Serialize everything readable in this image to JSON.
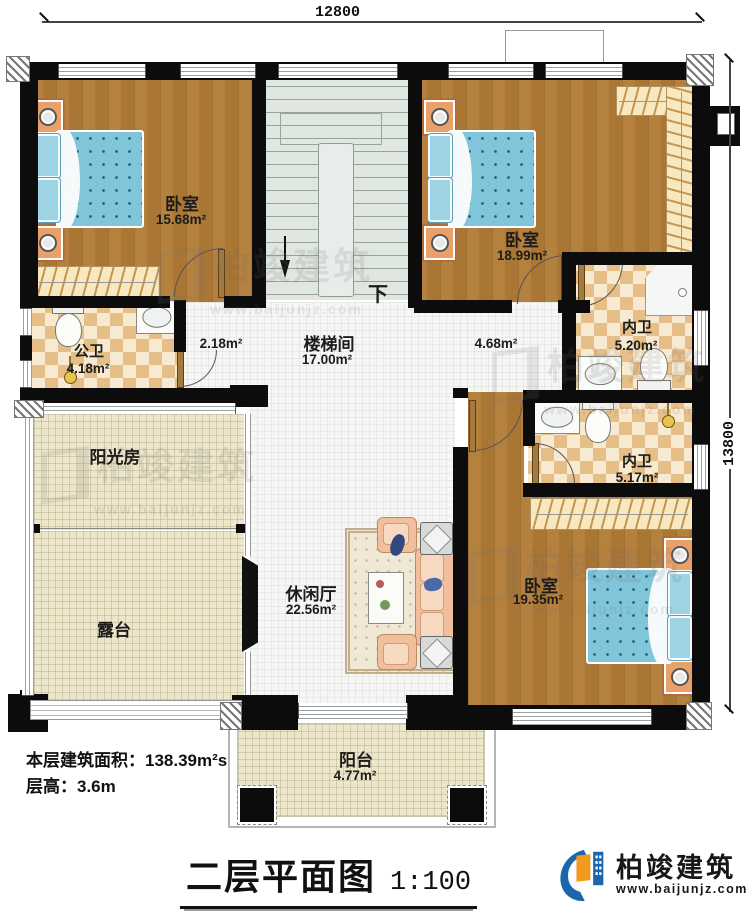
{
  "dimensions": {
    "top": "12800",
    "right": "13800"
  },
  "rooms": {
    "bedroom1": {
      "name": "卧室",
      "area": "15.68m²"
    },
    "bedroom2": {
      "name": "卧室",
      "area": "18.99m²"
    },
    "bedroom3": {
      "name": "卧室",
      "area": "19.35m²"
    },
    "stairwell": {
      "name": "楼梯间",
      "area": "17.00m²"
    },
    "public_bath": {
      "name": "公卫",
      "area": "4.18m²"
    },
    "corridor": {
      "area": "2.18m²"
    },
    "hall": {
      "area": "4.68m²"
    },
    "inner_bath1": {
      "name": "内卫",
      "area": "5.20m²"
    },
    "inner_bath2": {
      "name": "内卫",
      "area": "5.17m²"
    },
    "sunroom": {
      "name": "阳光房"
    },
    "terrace": {
      "name": "露台"
    },
    "leisure": {
      "name": "休闲厅",
      "area": "22.56m²"
    },
    "balcony": {
      "name": "阳台",
      "area": "4.77m²"
    }
  },
  "stairs": {
    "down_label": "下"
  },
  "notes": {
    "area_line": "本层建筑面积：138.39m²s",
    "height_line": "层高：3.6m"
  },
  "title": {
    "text": "二层平面图",
    "scale": "1:100"
  },
  "logo": {
    "name": "柏竣建筑",
    "url": "www.baijunjz.com"
  },
  "watermark": {
    "name": "柏竣建筑",
    "url": "www.baijunjz.com"
  },
  "colors": {
    "wall": "#0c0c0c",
    "wood_floor": "#b5813f",
    "bath_tile": "#e6be87",
    "cream_floor": "#ede6cb",
    "stair_floor": "#e0e6e0",
    "bed_blue": "#80c5d9",
    "nightstand_orange": "#e9a169",
    "logo_blue": "#1b66ac",
    "logo_orange": "#f29a1e"
  }
}
